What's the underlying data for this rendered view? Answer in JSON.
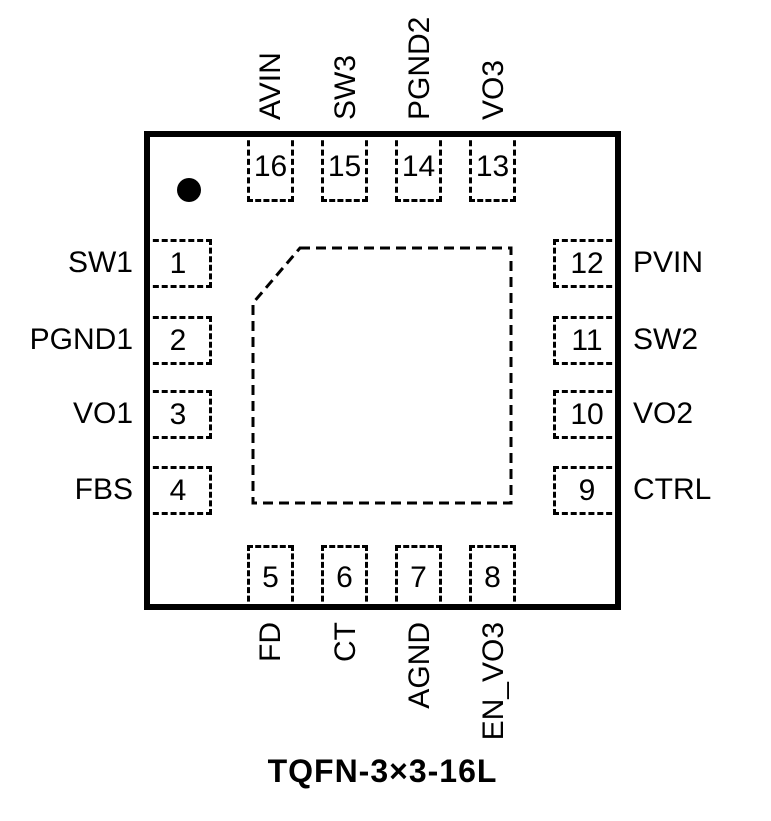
{
  "package": {
    "caption": "TQFN-3×3-16L"
  },
  "colors": {
    "line": "#000000",
    "background": "#ffffff"
  },
  "pins": {
    "top": [
      {
        "num": "16",
        "label": "AVIN"
      },
      {
        "num": "15",
        "label": "SW3"
      },
      {
        "num": "14",
        "label": "PGND2"
      },
      {
        "num": "13",
        "label": "VO3"
      }
    ],
    "left": [
      {
        "num": "1",
        "label": "SW1"
      },
      {
        "num": "2",
        "label": "PGND1"
      },
      {
        "num": "3",
        "label": "VO1"
      },
      {
        "num": "4",
        "label": "FBS"
      }
    ],
    "right": [
      {
        "num": "12",
        "label": "PVIN"
      },
      {
        "num": "11",
        "label": "SW2"
      },
      {
        "num": "10",
        "label": "VO2"
      },
      {
        "num": "9",
        "label": "CTRL"
      }
    ],
    "bottom": [
      {
        "num": "5",
        "label": "FD"
      },
      {
        "num": "6",
        "label": "CT"
      },
      {
        "num": "7",
        "label": "AGND"
      },
      {
        "num": "8",
        "label": "EN_VO3"
      }
    ]
  }
}
